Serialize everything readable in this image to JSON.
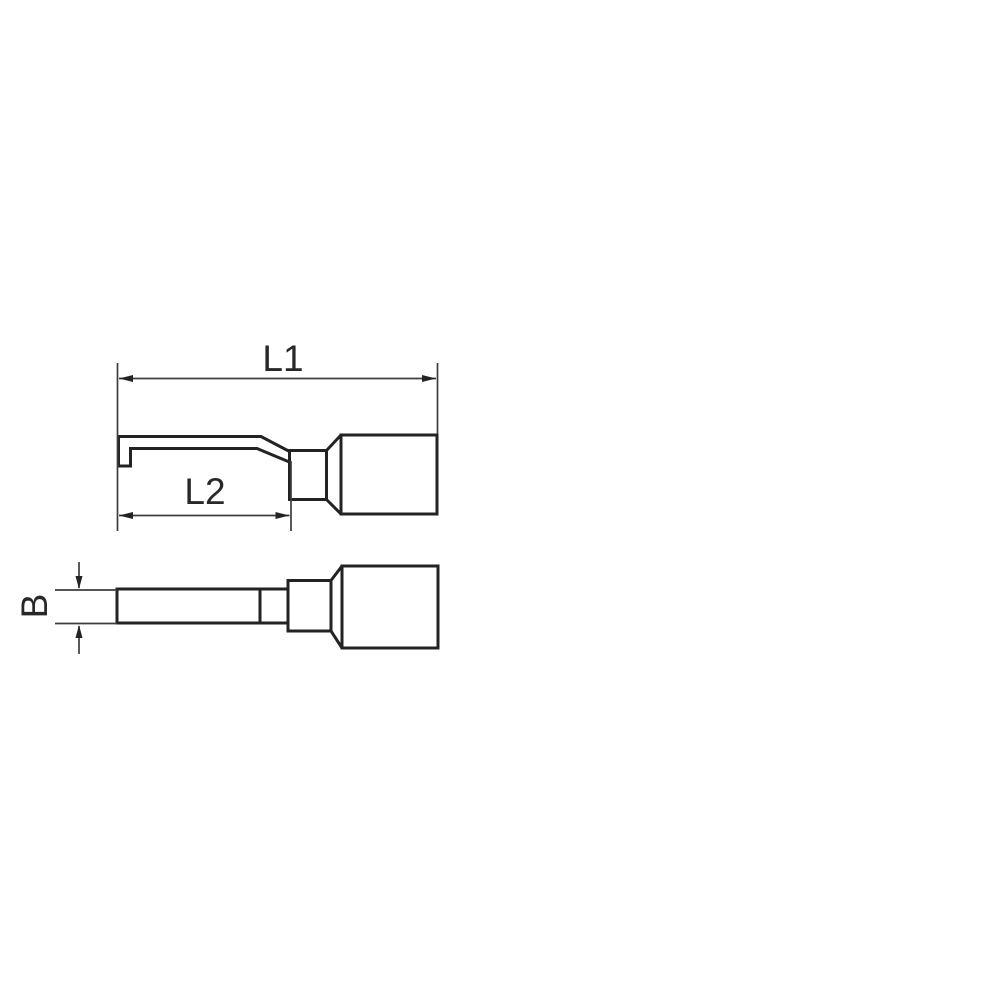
{
  "page": {
    "background": "#ffffff"
  },
  "drawing": {
    "type": "technical-dimension-drawing",
    "subject": "hooked-blade-terminal",
    "colors": {
      "outline": "#232323",
      "dimension_line": "#3d3d3d",
      "text": "#282828",
      "background": "#ffffff"
    },
    "views": {
      "side_view": {
        "dimension_labels": [
          "L1",
          "L2"
        ]
      },
      "top_view": {
        "dimension_labels": [
          "B"
        ]
      }
    },
    "labels": {
      "L1": "L1",
      "L2": "L2",
      "B": "B"
    }
  }
}
